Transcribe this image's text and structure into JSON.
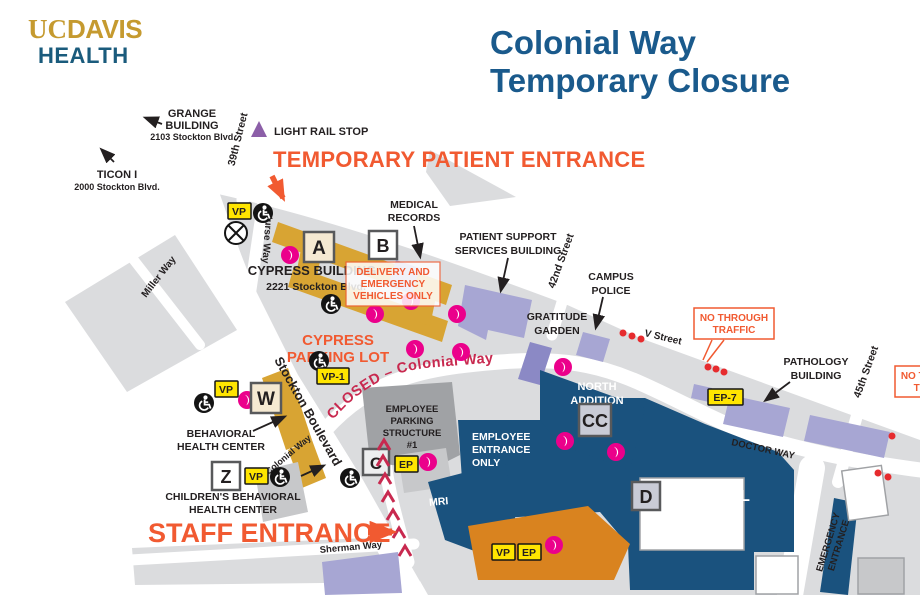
{
  "logo": {
    "uc": "UC",
    "davis": "DAVIS",
    "health": "HEALTH"
  },
  "title": {
    "line1": "Colonial Way",
    "line2": "Temporary Closure"
  },
  "annotations": {
    "temporary_patient_entrance": "TEMPORARY PATIENT ENTRANCE",
    "staff_entrance": "STAFF ENTRANCE",
    "closed_road": "CLOSED – Colonial Way",
    "no_through_traffic": [
      "NO THROUGH",
      "TRAFFIC"
    ],
    "delivery_note": [
      "DELIVERY AND",
      "EMERGENCY",
      "VEHICLES ONLY"
    ],
    "light_rail_stop": "LIGHT RAIL STOP"
  },
  "streets": {
    "s39th": "39th Street",
    "nurse": "Nurse Way",
    "miller": "Miller Way",
    "stockton": "Stockton Boulevard",
    "s42nd": "42nd Street",
    "v": "V Street",
    "s45th": "45th Street",
    "doctor": "DOCTOR WAY",
    "colonial": "Colonial Way",
    "sherman": "Sherman Way"
  },
  "buildings": {
    "grange": [
      "GRANGE",
      "BUILDING"
    ],
    "grange_addr": "2103 Stockton Blvd.",
    "ticon": "TICON I",
    "ticon_addr": "2000 Stockton Blvd.",
    "medical_records": [
      "MEDICAL",
      "RECORDS"
    ],
    "patient_support": [
      "PATIENT SUPPORT",
      "SERVICES BUILDING"
    ],
    "campus_police": [
      "CAMPUS",
      "POLICE"
    ],
    "gratitude_garden": [
      "GRATITUDE",
      "GARDEN"
    ],
    "pathology": [
      "PATHOLOGY",
      "BUILDING"
    ],
    "cypress": "CYPRESS BUILDING",
    "cypress_addr": "2221 Stockton Blvd.",
    "cypress_lot": [
      "CYPRESS",
      "PARKING LOT"
    ],
    "employee_parking": [
      "EMPLOYEE",
      "PARKING",
      "STRUCTURE",
      "#1"
    ],
    "employee_entrance": [
      "EMPLOYEE",
      "ENTRANCE",
      "ONLY"
    ],
    "north_addition": [
      "NORTH",
      "ADDITION"
    ],
    "hospital": "HOSPITAL",
    "mri": "MRI",
    "emergency_entrance": [
      "EMERGENCY",
      "ENTRANCE"
    ],
    "behavioral": [
      "BEHAVIORAL",
      "HEALTH CENTER"
    ],
    "childrens": [
      "CHILDREN'S BEHAVIORAL",
      "HEALTH CENTER"
    ]
  },
  "badges": {
    "a": "A",
    "b": "B",
    "c": "C",
    "cc": "CC",
    "d": "D",
    "w": "W",
    "z": "Z",
    "vp": "VP",
    "vp1": "VP-1",
    "ep": "EP",
    "ep7": "EP-7"
  },
  "colors": {
    "brand_gold": "#C59A2F",
    "health_blue": "#1A5B7C",
    "title_blue": "#1A5A8C",
    "accent_orange": "#F15A31",
    "closure_crimson": "#C8294F",
    "hospital_blue": "#1A527E",
    "building_gold": "#D8A433",
    "building_lavender": "#A7A6D3",
    "garden_purple": "#8B89C5",
    "structure_gray": "#A0A2A5",
    "map_gray": "#DBDCDE",
    "badge_yellow": "#FFE500",
    "marker_magenta": "#EB008B",
    "dot_red": "#E62B2E",
    "light_rail_purple": "#8C5FA8"
  }
}
